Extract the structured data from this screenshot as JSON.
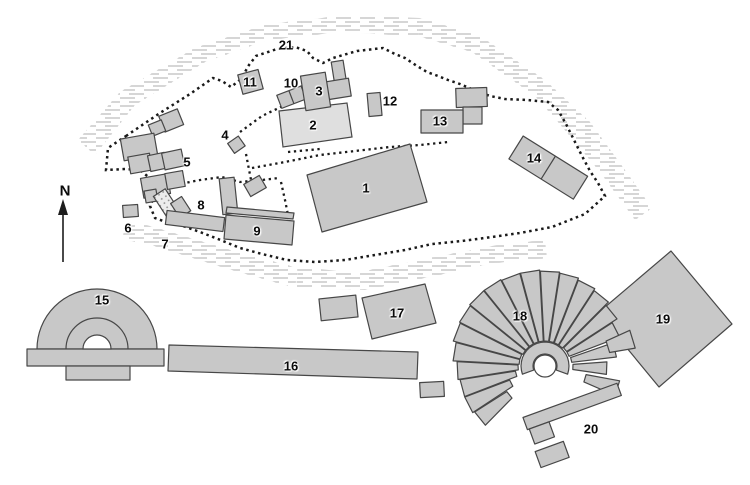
{
  "labels": [
    {
      "text": "1"
    },
    {
      "text": "2"
    },
    {
      "text": "3"
    },
    {
      "text": "4"
    },
    {
      "text": "5"
    },
    {
      "text": "6"
    },
    {
      "text": "7"
    },
    {
      "text": "8"
    },
    {
      "text": "9"
    },
    {
      "text": "10"
    },
    {
      "text": "11"
    },
    {
      "text": "12"
    },
    {
      "text": "13"
    },
    {
      "text": "14"
    },
    {
      "text": "15"
    },
    {
      "text": "16"
    },
    {
      "text": "17"
    },
    {
      "text": "18"
    },
    {
      "text": "19"
    },
    {
      "text": "20"
    },
    {
      "text": "21"
    },
    {
      "text": "N"
    }
  ],
  "colors": {
    "background": "#ffffff",
    "building_fill": "#c8c8c8",
    "building_fill_light": "#dfdfdf",
    "building_outline": "#474747",
    "hachure_line": "#b5b5b5",
    "dotted_line": "#1a1a1a",
    "label_color": "#0a0a0a"
  },
  "fan": {
    "cx": 545,
    "cy": 366,
    "wedges": [
      [
        219,
        46,
        84
      ],
      [
        207,
        38,
        86
      ],
      [
        195,
        30,
        86
      ],
      [
        183,
        27,
        88
      ],
      [
        171,
        26,
        92
      ],
      [
        159,
        26,
        95
      ],
      [
        147,
        25,
        96
      ],
      [
        135,
        25,
        97
      ],
      [
        123,
        25,
        97
      ],
      [
        111,
        25,
        96
      ],
      [
        99,
        25,
        96
      ],
      [
        87,
        25,
        95
      ],
      [
        75,
        25,
        94
      ],
      [
        63,
        25,
        92
      ],
      [
        51,
        25,
        90
      ],
      [
        39,
        26,
        86
      ],
      [
        27,
        26,
        80
      ],
      [
        13,
        27,
        72
      ],
      [
        -2,
        28,
        62
      ],
      [
        17,
        66,
        92
      ],
      [
        -17,
        42,
        76
      ]
    ],
    "orchestra": {
      "outer_r": 24,
      "inner_r": 12,
      "start_deg": 200,
      "end_deg": -20
    }
  }
}
